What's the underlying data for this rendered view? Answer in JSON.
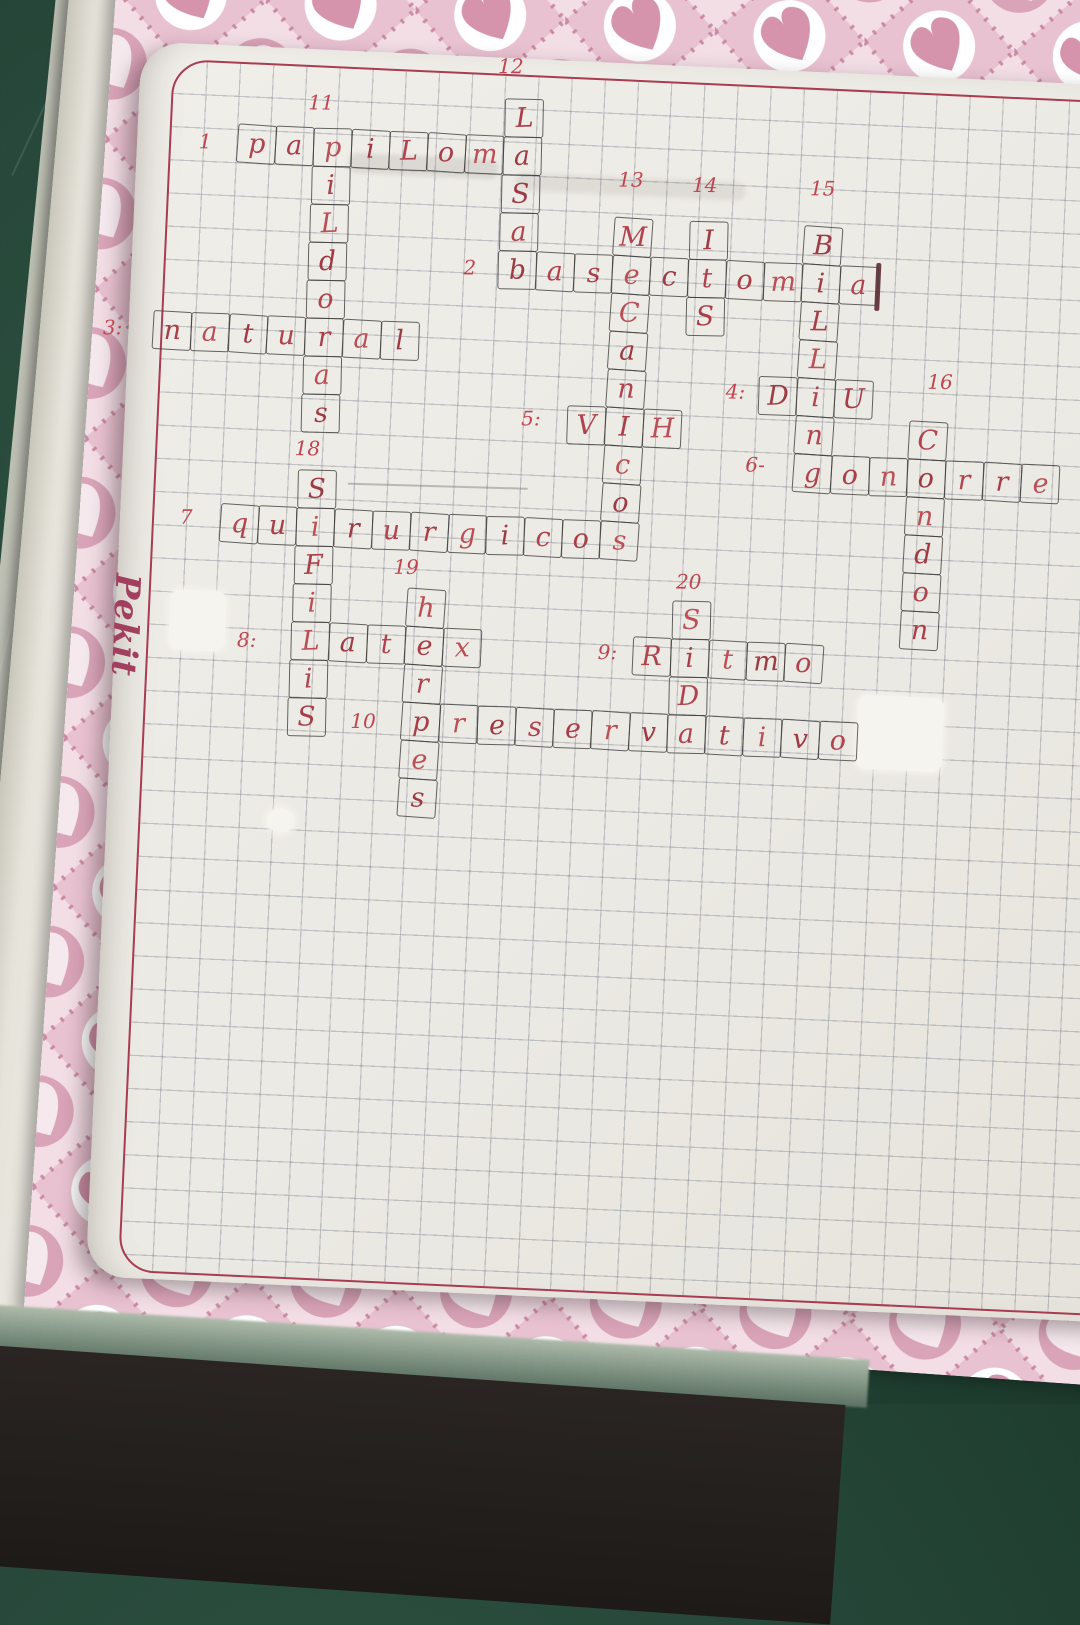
{
  "notebook": {
    "brand_logo": "Pekit",
    "colors": {
      "table_green": "#27483a",
      "cover_pink_base": "#eed3dd",
      "cover_heart_pink": "#d593ac",
      "cover_circle_pink": "#d9a3b8",
      "paper": "#ebe9e3",
      "margin_frame_red": "#a83c52",
      "grid_line": "#6a6e7c",
      "pen_red": "#b0434e",
      "box_pencil": "#403e3c"
    }
  },
  "crossword": {
    "language": "es",
    "theme": "salud sexual / métodos anticonceptivos",
    "entries": [
      {
        "num": "1",
        "label": "1",
        "answer": "papiloma",
        "dir": "across",
        "row": 1,
        "col": 3,
        "letters": [
          "p",
          "a",
          "p",
          "i",
          "L",
          "o",
          "m",
          "a"
        ],
        "skip": [],
        "label_pos": [
          2.15,
          1.5
        ]
      },
      {
        "num": "2",
        "label": "2",
        "answer": "basectomia",
        "dir": "across",
        "row": 4,
        "col": 10,
        "letters": [
          "b",
          "a",
          "s",
          "e",
          "c",
          "t",
          "o",
          "m",
          "i",
          "a"
        ],
        "skip": [],
        "label_pos": [
          9.25,
          4.5
        ]
      },
      {
        "num": "3",
        "label": "3:",
        "answer": "natural",
        "dir": "across",
        "row": 6,
        "col": 1,
        "letters": [
          "n",
          "a",
          "t",
          "u",
          "r",
          "a",
          "l"
        ],
        "skip": [],
        "label_pos": [
          -0.05,
          6.5
        ]
      },
      {
        "num": "4",
        "label": "4:",
        "answer": "DIU",
        "dir": "across",
        "row": 7,
        "col": 17,
        "letters": [
          "D",
          "i",
          "U"
        ],
        "skip": [],
        "label_pos": [
          16.4,
          7.45
        ]
      },
      {
        "num": "5",
        "label": "5:",
        "answer": "VIH",
        "dir": "across",
        "row": 8,
        "col": 12,
        "letters": [
          "V",
          "I",
          "H"
        ],
        "skip": [],
        "label_pos": [
          11.05,
          8.4
        ]
      },
      {
        "num": "6",
        "label": "6-",
        "answer": "gonorrea",
        "dir": "across",
        "row": 9,
        "col": 18,
        "letters": [
          "g",
          "o",
          "n",
          "o",
          "r",
          "r",
          "e"
        ],
        "truncated": true,
        "skip": [],
        "label_pos": [
          17.0,
          9.35
        ]
      },
      {
        "num": "7",
        "label": "7",
        "answer": "quirurgicos",
        "dir": "across",
        "row": 11,
        "col": 3,
        "letters": [
          "q",
          "u",
          "i",
          "r",
          "u",
          "r",
          "g",
          "i",
          "c",
          "o",
          "s"
        ],
        "skip": [],
        "label_pos": [
          2.1,
          11.4
        ]
      },
      {
        "num": "8",
        "label": "8:",
        "answer": "latex",
        "dir": "across",
        "row": 14,
        "col": 5,
        "letters": [
          "L",
          "a",
          "t",
          "e",
          "x"
        ],
        "skip": [],
        "label_pos": [
          3.85,
          14.55
        ]
      },
      {
        "num": "9",
        "label": "9:",
        "answer": "ritmo",
        "dir": "across",
        "row": 14,
        "col": 14,
        "letters": [
          "R",
          "i",
          "t",
          "m",
          "o"
        ],
        "skip": [],
        "label_pos": [
          13.35,
          14.45
        ]
      },
      {
        "num": "10",
        "label": "10",
        "answer": "preservativo",
        "dir": "across",
        "row": 16,
        "col": 8,
        "letters": [
          "p",
          "r",
          "e",
          "s",
          "e",
          "r",
          "v",
          "a",
          "t",
          "i",
          "v",
          "o"
        ],
        "skip": [],
        "label_pos": [
          7.0,
          16.55
        ]
      },
      {
        "num": "11",
        "label": "11",
        "answer": "pildoras",
        "dir": "down",
        "row": 1,
        "col": 5,
        "letters": [
          "p",
          "i",
          "L",
          "d",
          "o",
          "r",
          "a",
          "s"
        ],
        "skip": [
          0,
          5
        ],
        "label_pos": [
          5.15,
          0.35
        ]
      },
      {
        "num": "12",
        "label": "12",
        "answer": "basal",
        "dir": "down",
        "row": 0,
        "col": 10,
        "letters": [
          "L",
          "a",
          "S",
          "a",
          "b"
        ],
        "skip": [
          1,
          4
        ],
        "label_pos": [
          10.1,
          -0.85
        ]
      },
      {
        "num": "13",
        "label": "13",
        "answer": "mecanicos",
        "dir": "down",
        "row": 3,
        "col": 13,
        "letters": [
          "M",
          "e",
          "C",
          "a",
          "n",
          "i",
          "c",
          "o",
          "s"
        ],
        "skip": [
          1,
          5,
          8
        ],
        "label_pos": [
          13.4,
          2.0
        ]
      },
      {
        "num": "14",
        "label": "14",
        "answer": "ITS",
        "dir": "down",
        "row": 3,
        "col": 15,
        "letters": [
          "I",
          "t",
          "S"
        ],
        "skip": [
          1
        ],
        "label_pos": [
          15.35,
          2.05
        ]
      },
      {
        "num": "15",
        "label": "15",
        "answer": "billings",
        "dir": "down",
        "row": 3,
        "col": 18,
        "letters": [
          "B",
          "i",
          "L",
          "L",
          "i",
          "n",
          "g"
        ],
        "skip": [
          1,
          4,
          6
        ],
        "label_pos": [
          18.45,
          2.0
        ]
      },
      {
        "num": "16",
        "label": "16",
        "answer": "condon",
        "dir": "down",
        "row": 8,
        "col": 21,
        "letters": [
          "C",
          "o",
          "n",
          "d",
          "o",
          "n"
        ],
        "skip": [
          1
        ],
        "label_pos": [
          21.75,
          6.95
        ]
      },
      {
        "num": "18",
        "label": "18",
        "answer": "sifilis",
        "dir": "down",
        "row": 10,
        "col": 5,
        "letters": [
          "S",
          "i",
          "F",
          "i",
          "L",
          "i",
          "S"
        ],
        "skip": [
          1,
          4
        ],
        "label_pos": [
          5.2,
          9.45
        ]
      },
      {
        "num": "19",
        "label": "19",
        "answer": "herpes",
        "dir": "down",
        "row": 13,
        "col": 8,
        "letters": [
          "h",
          "e",
          "r",
          "p",
          "e",
          "s"
        ],
        "skip": [
          1,
          3
        ],
        "label_pos": [
          7.95,
          12.45
        ]
      },
      {
        "num": "20",
        "label": "20",
        "answer": "sida",
        "dir": "down",
        "row": 13,
        "col": 15,
        "letters": [
          "S",
          "i",
          "D",
          "a"
        ],
        "skip": [
          1,
          3
        ],
        "label_pos": [
          15.4,
          12.5
        ]
      }
    ]
  }
}
